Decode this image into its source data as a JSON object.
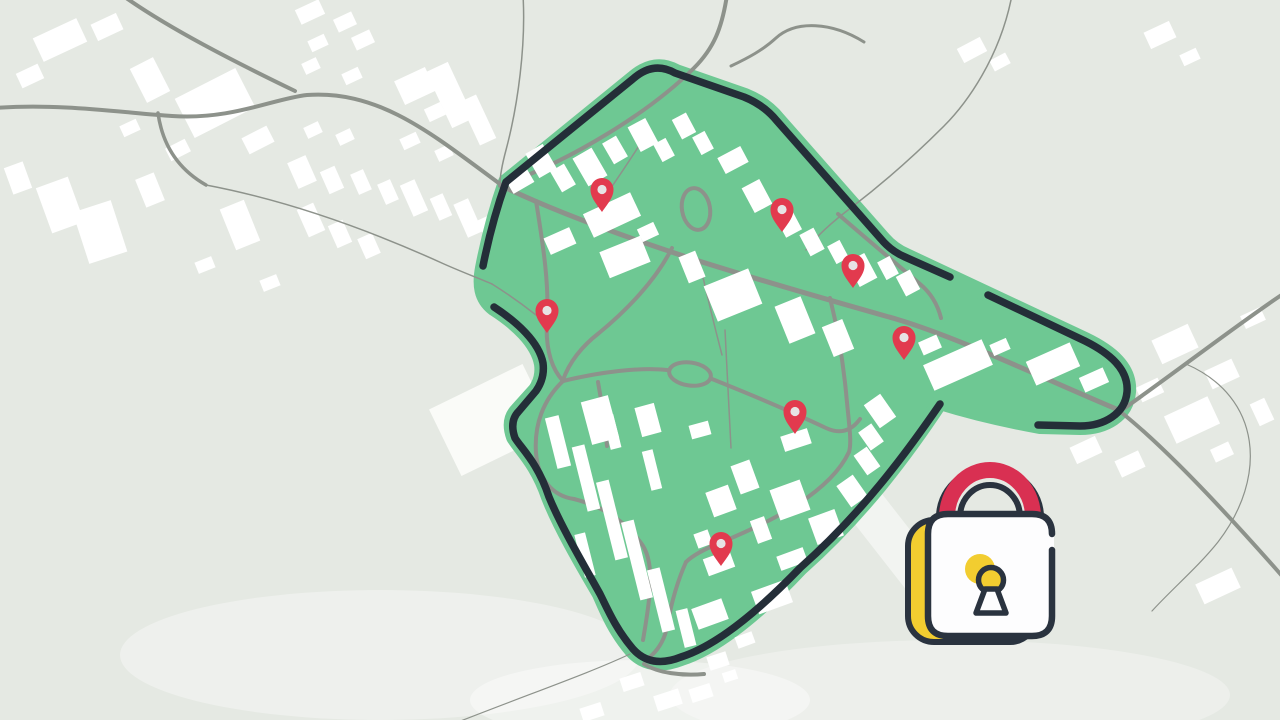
{
  "scene": {
    "description": "stylized map illustration with secured green geofence zone, red location pins and a padlock icon",
    "width": 1280,
    "height": 720
  },
  "colors": {
    "background": "#e5e9e3",
    "building": "#ffffff",
    "building_soft": "#fafbf8",
    "road": "#8d928b",
    "zone_green": "#6ec893",
    "zone_border": "#242e38",
    "pin_red": "#e23a4e",
    "pin_dot": "#e7e3e4",
    "lock_dark": "#2a333f",
    "lock_red": "#d93052",
    "lock_yellow": "#f2cd30",
    "lock_white": "#fdfdfe",
    "wash_white": "#ffffff"
  },
  "washes": [
    {
      "type": "ellipse",
      "cx": 380,
      "cy": 655,
      "rx": 260,
      "ry": 65,
      "opacity": 0.35
    },
    {
      "type": "ellipse",
      "cx": 950,
      "cy": 695,
      "rx": 280,
      "ry": 55,
      "opacity": 0.3
    },
    {
      "type": "rect",
      "cx": 877,
      "cy": 520,
      "w": 40,
      "h": 190,
      "rot": -38,
      "opacity": 0.5
    },
    {
      "type": "ellipse",
      "cx": 640,
      "cy": 700,
      "rx": 170,
      "ry": 40,
      "opacity": 0.4
    }
  ],
  "zone": {
    "fill_path": "M 483,268 C 489,237 497,208 506,182 L 634,78 Q 655,60 676,72 L 745,96 Q 765,104 778,120 L 882,238 Q 892,250 906,256 L 1085,340 C 1110,352 1130,368 1128,392 C 1126,415 1105,427 1080,427 L 1040,426 Q 985,416 940,402 C 905,455 860,515 800,568 C 770,600 722,645 681,658 Q 650,670 632,650 C 615,630 607,610 600,594 C 580,560 560,525 549,497 C 537,462 520,448 514,437 Q 508,420 518,410 L 536,390 Q 544,378 542,364 C 538,342 516,322 494,308 C 481,298 480,284 483,268 Z",
    "fill_edge_width": 16,
    "border_width": 7.5,
    "border_segments": [
      "M 483,266 C 489,236 497,207 506,182 L 634,78 Q 654,61 675,73 L 744,97 Q 764,105 777,121 L 881,239 Q 891,251 905,257 L 950,277",
      "M 988,295 L 1085,341 C 1109,353 1129,369 1127,392 C 1125,414 1104,426 1080,426 L 1038,425",
      "M 940,404 C 905,455 861,514 800,568 C 770,599 722,644 681,657 Q 651,669 633,649 C 616,629 608,610 600,594 C 581,560 561,526 549,497 C 538,463 521,448 515,438 Q 509,421 519,411 L 536,391 Q 545,378 543,363 C 539,342 517,322 494,307"
    ]
  },
  "roads": {
    "outside": [
      {
        "d": "M -5,108 C 60,103 125,113 172,116 C 232,120 272,99 307,95 C 380,90 432,134 500,184",
        "w": 4
      },
      {
        "d": "M 122,-5 C 168,28 235,62 295,91",
        "w": 4
      },
      {
        "d": "M 158,113 C 162,142 176,168 206,185",
        "w": 3.5
      },
      {
        "d": "M 206,185 C 285,200 365,228 444,264 C 462,272 478,278 492,284",
        "w": 1.5
      },
      {
        "d": "M 727,-5 C 722,28 714,48 694,68 C 650,112 572,160 500,186",
        "w": 4
      },
      {
        "d": "M 864,42 C 832,22 796,20 776,38 C 763,50 748,58 731,66",
        "w": 3
      },
      {
        "d": "M 1012,-5 C 1000,58 966,104 944,126 C 916,154 882,184 852,207 C 836,219 818,234 806,250",
        "w": 1.5
      },
      {
        "d": "M 1122,410 C 1180,369 1242,321 1283,294",
        "w": 4
      },
      {
        "d": "M 1122,413 C 1167,449 1232,519 1283,577",
        "w": 4
      },
      {
        "d": "M 1186,364 C 1262,397 1268,477 1218,542 C 1198,567 1172,589 1152,611",
        "w": 1.2
      },
      {
        "d": "M 630,654 C 592,672 540,690 458,722",
        "w": 1.2
      },
      {
        "d": "M 644,664 C 658,673 682,676 704,674",
        "w": 4
      },
      {
        "d": "M 523,-5 C 526,45 518,105 506,150 C 502,165 500,175 500,184",
        "w": 1.5
      }
    ],
    "inside": [
      {
        "d": "M 502,186 C 560,214 640,242 702,262 C 782,287 850,306 896,319 C 960,338 1042,378 1121,411",
        "w": 5
      },
      {
        "d": "M 536,201 C 544,250 549,286 547,318 C 545,348 551,368 563,381",
        "w": 4
      },
      {
        "d": "M 563,381 C 600,372 640,367 667,370",
        "w": 4
      },
      {
        "d": "M 712,379 C 742,391 790,411 826,428 C 841,435 852,430 860,419",
        "w": 4
      },
      {
        "d": "M 672,248 C 656,280 627,310 599,333 C 581,347 569,363 563,380",
        "w": 4
      },
      {
        "d": "M 830,298 C 838,330 843,362 846,392 C 849,425 852,442 849,452 C 830,492 775,520 722,542 C 702,550 692,556 686,562",
        "w": 4
      },
      {
        "d": "M 838,214 C 862,235 892,260 920,284 C 932,294 938,306 941,318",
        "w": 4
      },
      {
        "d": "M 725,330 C 727,370 729,410 731,448",
        "w": 1.5
      },
      {
        "d": "M 700,264 C 708,300 716,332 722,355",
        "w": 1.5
      },
      {
        "d": "M 492,284 C 508,294 522,304 536,315",
        "w": 1.5
      },
      {
        "d": "M 648,132 C 630,160 610,190 592,215",
        "w": 1.5
      },
      {
        "d": "M 563,381 C 543,400 534,425 536,453 C 538,478 552,496 574,499",
        "w": 4
      },
      {
        "d": "M 574,499 C 602,506 624,520 641,543 C 656,562 650,600 643,640",
        "w": 4
      },
      {
        "d": "M 598,382 C 602,404 605,425 607,446",
        "w": 4
      },
      {
        "d": "M 686,562 C 678,580 672,600 668,622 C 666,636 660,650 646,660",
        "w": 4
      }
    ],
    "rings": [
      {
        "cx": 690,
        "cy": 374,
        "rx": 21,
        "ry": 11.5,
        "rot": 8,
        "w": 4
      },
      {
        "cx": 696,
        "cy": 209,
        "rx": 14,
        "ry": 21,
        "rot": -10,
        "w": 4
      }
    ]
  },
  "buildings": {
    "outside": [
      [
        60,
        40,
        48,
        26,
        -25
      ],
      [
        107,
        27,
        28,
        18,
        -25
      ],
      [
        30,
        76,
        24,
        16,
        -25
      ],
      [
        150,
        80,
        26,
        38,
        -27
      ],
      [
        215,
        103,
        68,
        44,
        -27
      ],
      [
        258,
        140,
        28,
        18,
        -27
      ],
      [
        178,
        150,
        22,
        14,
        -27
      ],
      [
        130,
        128,
        18,
        12,
        -25
      ],
      [
        60,
        205,
        34,
        48,
        -20
      ],
      [
        100,
        232,
        40,
        54,
        -18
      ],
      [
        18,
        178,
        20,
        28,
        -20
      ],
      [
        150,
        190,
        20,
        30,
        -22
      ],
      [
        240,
        225,
        26,
        44,
        -22
      ],
      [
        205,
        265,
        18,
        12,
        -22
      ],
      [
        270,
        283,
        18,
        12,
        -22
      ],
      [
        310,
        12,
        26,
        16,
        -25
      ],
      [
        345,
        22,
        20,
        14,
        -25
      ],
      [
        318,
        43,
        18,
        12,
        -25
      ],
      [
        363,
        40,
        20,
        14,
        -25
      ],
      [
        311,
        66,
        16,
        12,
        -25
      ],
      [
        352,
        76,
        18,
        12,
        -25
      ],
      [
        415,
        86,
        34,
        26,
        -25
      ],
      [
        435,
        112,
        18,
        14,
        -25
      ],
      [
        313,
        130,
        16,
        12,
        -25
      ],
      [
        345,
        137,
        16,
        12,
        -25
      ],
      [
        410,
        141,
        18,
        12,
        -25
      ],
      [
        444,
        153,
        16,
        12,
        -25
      ],
      [
        302,
        172,
        20,
        28,
        -24
      ],
      [
        332,
        180,
        16,
        24,
        -24
      ],
      [
        361,
        182,
        14,
        22,
        -24
      ],
      [
        388,
        192,
        14,
        22,
        -24
      ],
      [
        414,
        198,
        16,
        34,
        -24
      ],
      [
        441,
        207,
        14,
        24,
        -24
      ],
      [
        468,
        218,
        16,
        36,
        -24
      ],
      [
        488,
        230,
        12,
        26,
        -24
      ],
      [
        311,
        220,
        18,
        30,
        -24
      ],
      [
        340,
        234,
        16,
        24,
        -24
      ],
      [
        369,
        246,
        16,
        22,
        -24
      ],
      [
        450,
        95,
        24,
        62,
        -25
      ],
      [
        478,
        120,
        18,
        48,
        -25
      ],
      [
        972,
        50,
        26,
        16,
        -28
      ],
      [
        1000,
        62,
        18,
        12,
        -28
      ],
      [
        1160,
        35,
        28,
        18,
        -25
      ],
      [
        1190,
        57,
        18,
        12,
        -25
      ],
      [
        1175,
        344,
        40,
        26,
        -25
      ],
      [
        1222,
        374,
        30,
        20,
        -25
      ],
      [
        1150,
        390,
        24,
        16,
        -25
      ],
      [
        1192,
        420,
        48,
        30,
        -25
      ],
      [
        1253,
        318,
        22,
        14,
        -25
      ],
      [
        1130,
        464,
        26,
        18,
        -25
      ],
      [
        1222,
        452,
        20,
        14,
        -25
      ],
      [
        1086,
        450,
        28,
        18,
        -25
      ],
      [
        1218,
        586,
        40,
        22,
        -25
      ],
      [
        1262,
        412,
        16,
        24,
        -25
      ],
      [
        632,
        682,
        22,
        14,
        -18
      ],
      [
        668,
        700,
        26,
        16,
        -18
      ],
      [
        701,
        693,
        22,
        14,
        -18
      ],
      [
        718,
        661,
        20,
        14,
        -18
      ],
      [
        592,
        712,
        22,
        14,
        -18
      ],
      [
        730,
        676,
        14,
        10,
        -18
      ]
    ],
    "slab": {
      "cx": 492,
      "cy": 420,
      "w": 104,
      "h": 74,
      "rot": -26
    },
    "inside": [
      [
        520,
        181,
        24,
        16,
        -30
      ],
      [
        541,
        161,
        20,
        28,
        -30
      ],
      [
        563,
        178,
        16,
        24,
        -30
      ],
      [
        590,
        167,
        22,
        32,
        -30
      ],
      [
        615,
        150,
        16,
        24,
        -30
      ],
      [
        643,
        135,
        20,
        28,
        -28
      ],
      [
        664,
        150,
        14,
        20,
        -28
      ],
      [
        684,
        126,
        16,
        22,
        -28
      ],
      [
        703,
        143,
        14,
        20,
        -28
      ],
      [
        612,
        215,
        52,
        26,
        -25
      ],
      [
        648,
        232,
        18,
        14,
        -25
      ],
      [
        733,
        160,
        26,
        18,
        -28
      ],
      [
        757,
        196,
        20,
        28,
        -28
      ],
      [
        788,
        222,
        18,
        26,
        -28
      ],
      [
        812,
        242,
        16,
        24,
        -28
      ],
      [
        838,
        252,
        14,
        20,
        -28
      ],
      [
        862,
        270,
        20,
        28,
        -28
      ],
      [
        888,
        268,
        14,
        20,
        -28
      ],
      [
        908,
        283,
        16,
        22,
        -28
      ],
      [
        560,
        241,
        28,
        18,
        -24
      ],
      [
        625,
        257,
        44,
        28,
        -22
      ],
      [
        692,
        267,
        18,
        28,
        -22
      ],
      [
        733,
        295,
        48,
        38,
        -22
      ],
      [
        795,
        320,
        28,
        40,
        -22
      ],
      [
        838,
        338,
        22,
        32,
        -22
      ],
      [
        930,
        345,
        20,
        14,
        -24
      ],
      [
        958,
        365,
        64,
        28,
        -24
      ],
      [
        1000,
        347,
        18,
        12,
        -24
      ],
      [
        1053,
        364,
        48,
        26,
        -24
      ],
      [
        1094,
        380,
        26,
        16,
        -24
      ],
      [
        600,
        420,
        28,
        44,
        -15
      ],
      [
        648,
        420,
        20,
        30,
        -15
      ],
      [
        700,
        430,
        20,
        14,
        -15
      ],
      [
        745,
        477,
        20,
        30,
        -20
      ],
      [
        796,
        440,
        28,
        16,
        -18
      ],
      [
        880,
        411,
        20,
        28,
        -35
      ],
      [
        871,
        437,
        16,
        22,
        -35
      ],
      [
        867,
        461,
        16,
        24,
        -35
      ],
      [
        852,
        491,
        20,
        26,
        -35
      ],
      [
        558,
        442,
        14,
        52,
        -14
      ],
      [
        586,
        478,
        13,
        66,
        -14
      ],
      [
        612,
        520,
        13,
        80,
        -14
      ],
      [
        637,
        560,
        13,
        80,
        -14
      ],
      [
        661,
        600,
        13,
        64,
        -14
      ],
      [
        686,
        628,
        12,
        38,
        -14
      ],
      [
        612,
        432,
        11,
        34,
        -14
      ],
      [
        585,
        555,
        11,
        44,
        -14
      ],
      [
        652,
        470,
        11,
        40,
        -14
      ],
      [
        721,
        501,
        24,
        26,
        -20
      ],
      [
        703,
        539,
        15,
        15,
        -20
      ],
      [
        790,
        500,
        32,
        32,
        -20
      ],
      [
        761,
        530,
        15,
        24,
        -20
      ],
      [
        826,
        527,
        28,
        28,
        -20
      ],
      [
        792,
        559,
        28,
        15,
        -20
      ],
      [
        719,
        563,
        28,
        18,
        -20
      ],
      [
        772,
        597,
        36,
        24,
        -20
      ],
      [
        710,
        614,
        32,
        22,
        -20
      ],
      [
        745,
        640,
        18,
        12,
        -20
      ]
    ]
  },
  "pins": {
    "count": 7,
    "shape_path": "M0 0 C-7 -10 -11.5 -15 -11.5 -22.5 A11.5 11.5 0 1 1 11.5 -22.5 C11.5 -15 7 -10 0 0 Z",
    "dot_radius": 4.6,
    "dot_offset_y": -22.5,
    "positions": [
      {
        "x": 602,
        "y": 212
      },
      {
        "x": 782,
        "y": 232
      },
      {
        "x": 853,
        "y": 288
      },
      {
        "x": 547,
        "y": 333
      },
      {
        "x": 904,
        "y": 360
      },
      {
        "x": 795,
        "y": 434
      },
      {
        "x": 721,
        "y": 566
      }
    ]
  },
  "lock": {
    "yellow_plate": {
      "x": 908,
      "y": 520,
      "w": 128,
      "h": 122,
      "rx": 26,
      "stroke_w": 6
    },
    "white_body": {
      "x": 926,
      "y": 512,
      "w": 128,
      "h": 126,
      "rx": 24
    },
    "body_outline_path": "M 1052,550 L 1052,616 Q 1052,636 1032,636 L 948,636 Q 928,636 928,616 L 928,534 Q 928,514 948,514 L 1032,514 Q 1052,514 1052,534",
    "body_outline_w": 6.5,
    "shackle_dark_outer": {
      "d": "M 939,517 A 51,49 0 0 1 1041,517",
      "w": 6
    },
    "shackle_red": {
      "d": "M 947,517 A 43,47 0 0 1 1033,517",
      "w": 16
    },
    "shackle_dark_inner": {
      "d": "M 960,517 A 30,32 0 0 1 1020,517",
      "w": 6
    },
    "keyhole_blob": {
      "cx": 980,
      "cy": 569,
      "r": 15
    },
    "keyhole_circle": {
      "cx": 991,
      "cy": 580,
      "r": 12.5,
      "stroke_w": 5.5
    },
    "keyhole_stem_path": "M 985,589 L 976,613 L 1006,613 L 997,589 Z",
    "keyhole_stem_stroke_w": 5.5
  }
}
